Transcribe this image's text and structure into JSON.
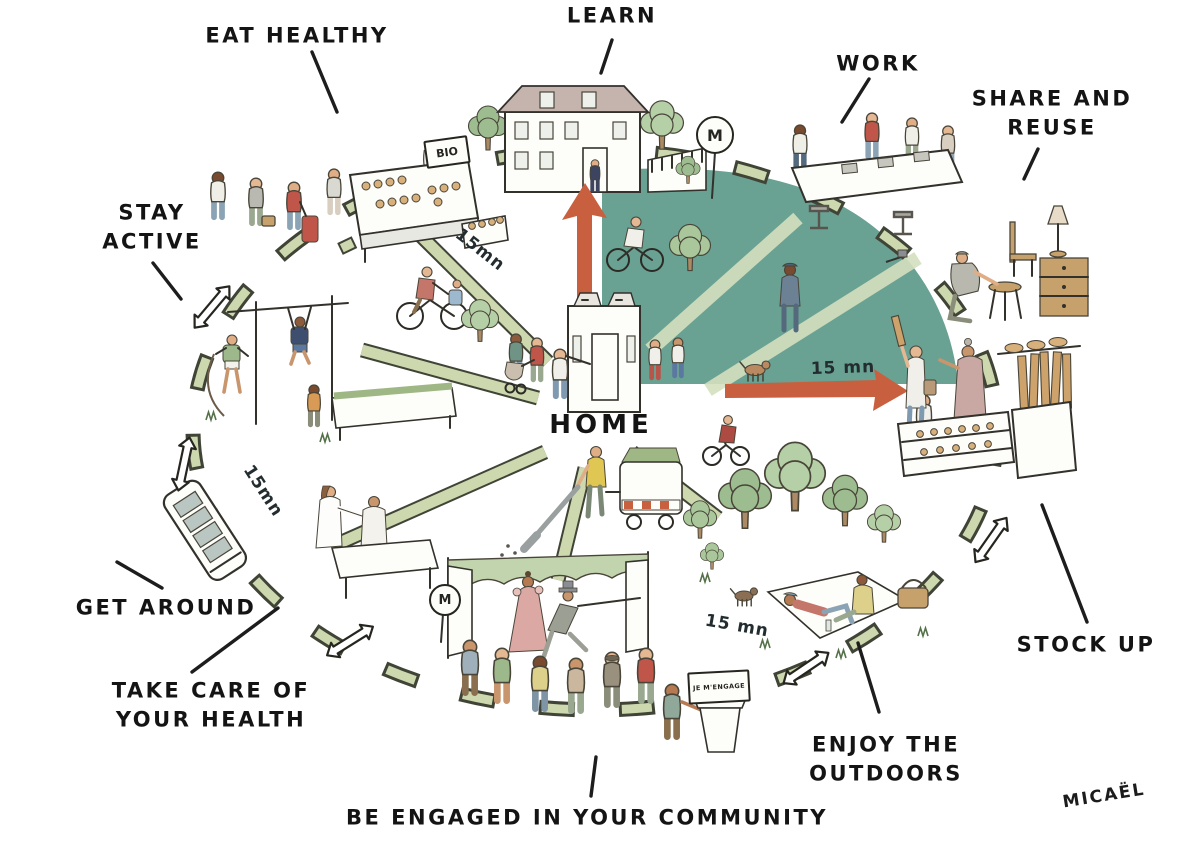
{
  "illustration": {
    "center_label": "HOME",
    "signature": "MICAËL",
    "activity_labels": {
      "eat_healthy": "EAT HEALTHY",
      "learn": "LEARN",
      "work": "WORK",
      "share_and_reuse": "SHARE AND REUSE",
      "stay_active": "STAY ACTIVE",
      "get_around": "GET AROUND",
      "take_care": "TAKE CARE OF YOUR HEALTH",
      "community": "BE ENGAGED IN YOUR COMMUNITY",
      "outdoors": "ENJOY THE OUTDOORS",
      "stock_up": "STOCK UP"
    },
    "time_markers": [
      "15mn",
      "15 mn",
      "15mn",
      "15 mn"
    ],
    "signs": {
      "organic": "BIO",
      "metro": "M",
      "pledge": "JE M'ENGAGE"
    },
    "colors": {
      "sector_teal": "#69a193",
      "path_green": "#cdd8af",
      "arrow_red": "#c8603f",
      "ink": "#1d1d1d",
      "background": "#ffffff"
    }
  }
}
